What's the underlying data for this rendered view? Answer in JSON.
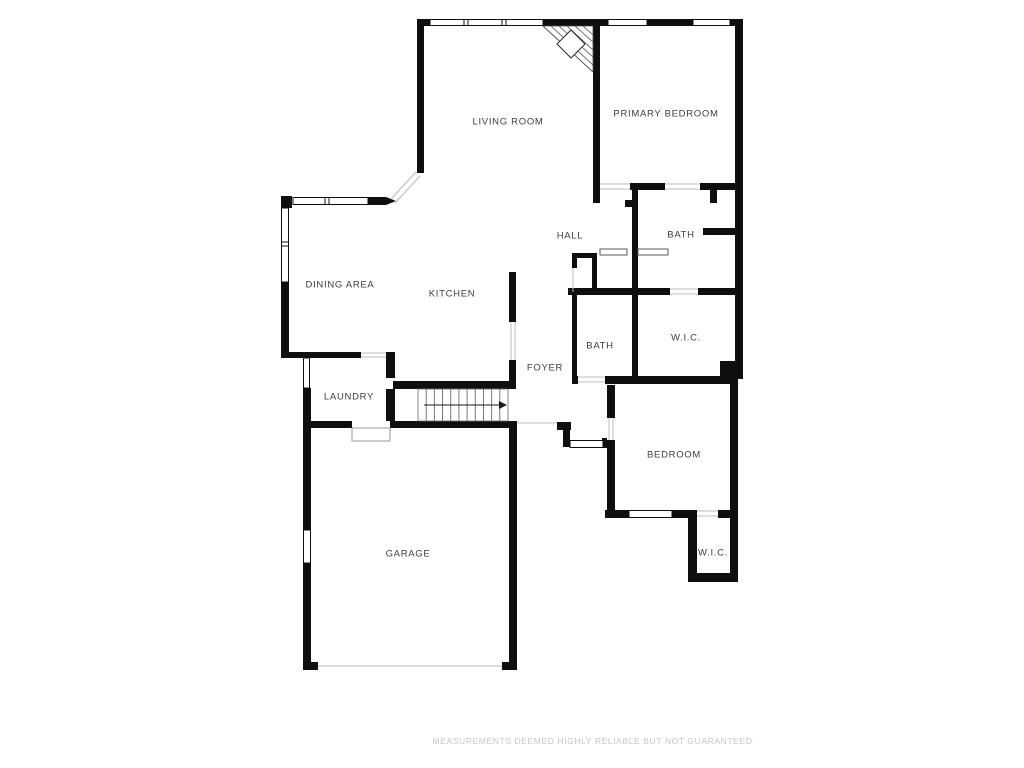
{
  "plan": {
    "rooms": [
      {
        "id": "living-room",
        "label": "LIVING ROOM",
        "x": 508,
        "y": 122
      },
      {
        "id": "primary-bedroom",
        "label": "PRIMARY BEDROOM",
        "x": 666,
        "y": 114
      },
      {
        "id": "hall",
        "label": "HALL",
        "x": 570,
        "y": 236
      },
      {
        "id": "bath-primary",
        "label": "BATH",
        "x": 681,
        "y": 235
      },
      {
        "id": "dining-area",
        "label": "DINING AREA",
        "x": 340,
        "y": 285
      },
      {
        "id": "kitchen",
        "label": "KITCHEN",
        "x": 452,
        "y": 294
      },
      {
        "id": "bath-2",
        "label": "BATH",
        "x": 600,
        "y": 346
      },
      {
        "id": "wic-primary",
        "label": "W.I.C.",
        "x": 686,
        "y": 338
      },
      {
        "id": "foyer",
        "label": "FOYER",
        "x": 545,
        "y": 368
      },
      {
        "id": "laundry",
        "label": "LAUNDRY",
        "x": 349,
        "y": 397
      },
      {
        "id": "bedroom",
        "label": "BEDROOM",
        "x": 674,
        "y": 455
      },
      {
        "id": "garage",
        "label": "GARAGE",
        "x": 408,
        "y": 554
      },
      {
        "id": "wic-bedroom",
        "label": "W.I.C.",
        "x": 713,
        "y": 553
      }
    ],
    "stairs": {
      "treads": 11,
      "direction": "up"
    },
    "disclaimer": "MEASUREMENTS DEEMED HIGHLY RELIABLE BUT NOT GUARANTEED."
  },
  "colors": {
    "wall": "#0f0f0f",
    "label": "#3d3d3d",
    "disclaimer": "#c5c5c9",
    "thin_line": "#bdbdc1",
    "hatch": "#4a4a4a"
  }
}
